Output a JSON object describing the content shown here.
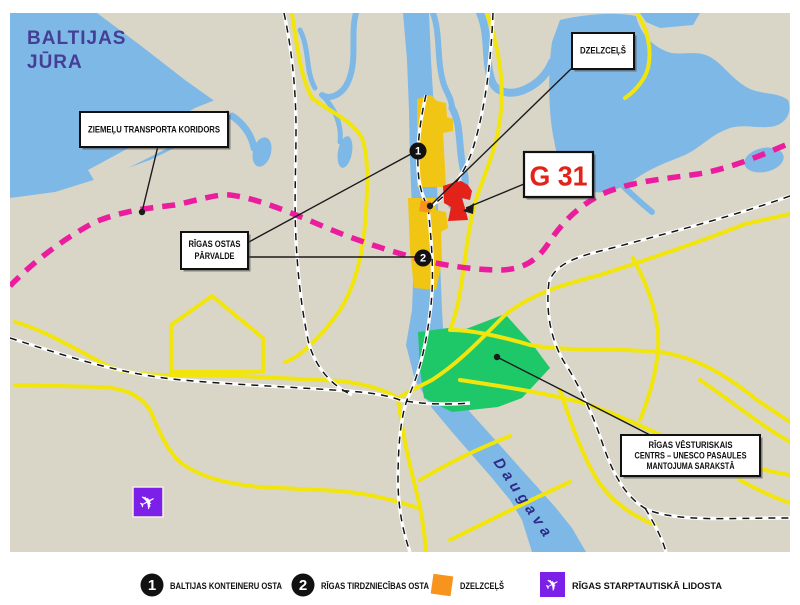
{
  "map": {
    "sea_label_line1": "BALTIJAS",
    "sea_label_line2": "JŪRA",
    "river_label": "Daugava",
    "site_code_label": "G 31",
    "callout_corridor": "ZIEMEĻU TRANSPORTA KORIDORS",
    "callout_railway": "DZELZCEĻŠ",
    "callout_port_authority_line1": "RĪGAS OSTAS",
    "callout_port_authority_line2": "PĀRVALDE",
    "callout_unesco_line1": "RĪGAS VĒSTURISKAIS",
    "callout_unesco_line2": "CENTRS – UNESCO PASAULES",
    "callout_unesco_line3": "MANTOJUMA SARAKSTĀ",
    "marker1_number": "1",
    "marker2_number": "2"
  },
  "legend": {
    "item1_number": "1",
    "item1_label": "BALTIJAS KONTEINERU OSTA",
    "item2_number": "2",
    "item2_label": "RĪGAS TIRDZNIECĪBAS OSTA",
    "item3_label": "DZELZCEĻŠ",
    "item4_label": "RĪGAS STARPTAUTISKĀ LIDOSTA"
  },
  "icons": {
    "airplane_glyph": "✈"
  },
  "colors": {
    "land": "#D9D6C8",
    "water": "#7EB8E6",
    "road_yellow": "#F1E50D",
    "port_area_gold": "#F1C513",
    "railway_marker_orange": "#F7941D",
    "corridor_magenta": "#EB1C9D",
    "unesco_green": "#1EC868",
    "site_red": "#E32219",
    "airport_purple": "#7C1FE8",
    "sea_label_ink": "#443E95",
    "river_label_ink": "#2E2A87"
  }
}
